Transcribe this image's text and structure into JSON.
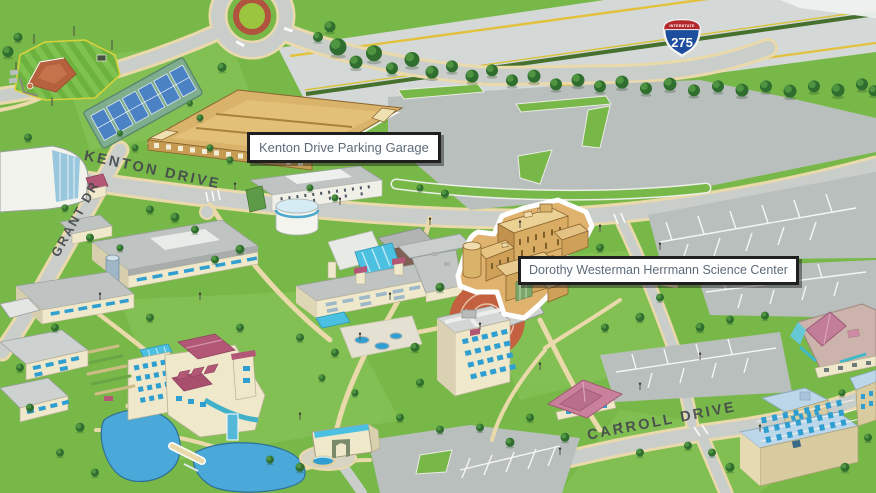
{
  "canvas": {
    "width": 876,
    "height": 493
  },
  "callouts": {
    "garage": {
      "text": "Kenton Drive Parking Garage"
    },
    "science": {
      "text": "Dorothy Westerman Herrmann Science Center"
    }
  },
  "road_labels": {
    "kenton": "KENTON DRIVE",
    "grant": "GRANT DR",
    "carroll": "CARROLL DRIVE"
  },
  "highway_shield": {
    "banner": "INTERSTATE",
    "number": "275"
  },
  "colors": {
    "grass": "#78b848",
    "grass-light": "#8cc75f",
    "road": "#c9cecb",
    "parking": "#b9bfbc",
    "highway": "#d4d8d6",
    "curb": "#ead9ab",
    "water": "#4aa9d8",
    "tree-dark": "#2f6e2f",
    "tree-light": "#4f9440",
    "gold": "#d9b36a",
    "gold-roof": "#ecd194",
    "cream": "#efe8cb",
    "roof-gray": "#bfc4c2",
    "maroon": "#b25876",
    "glass-blue": "#4cc0e0",
    "window-blue": "#2e9fd0",
    "shield-red": "#b3282d",
    "shield-blue": "#1d4e9e",
    "label-text": "#5d6b79",
    "road-text": "#45494d",
    "label-border": "#1f1f1f"
  }
}
